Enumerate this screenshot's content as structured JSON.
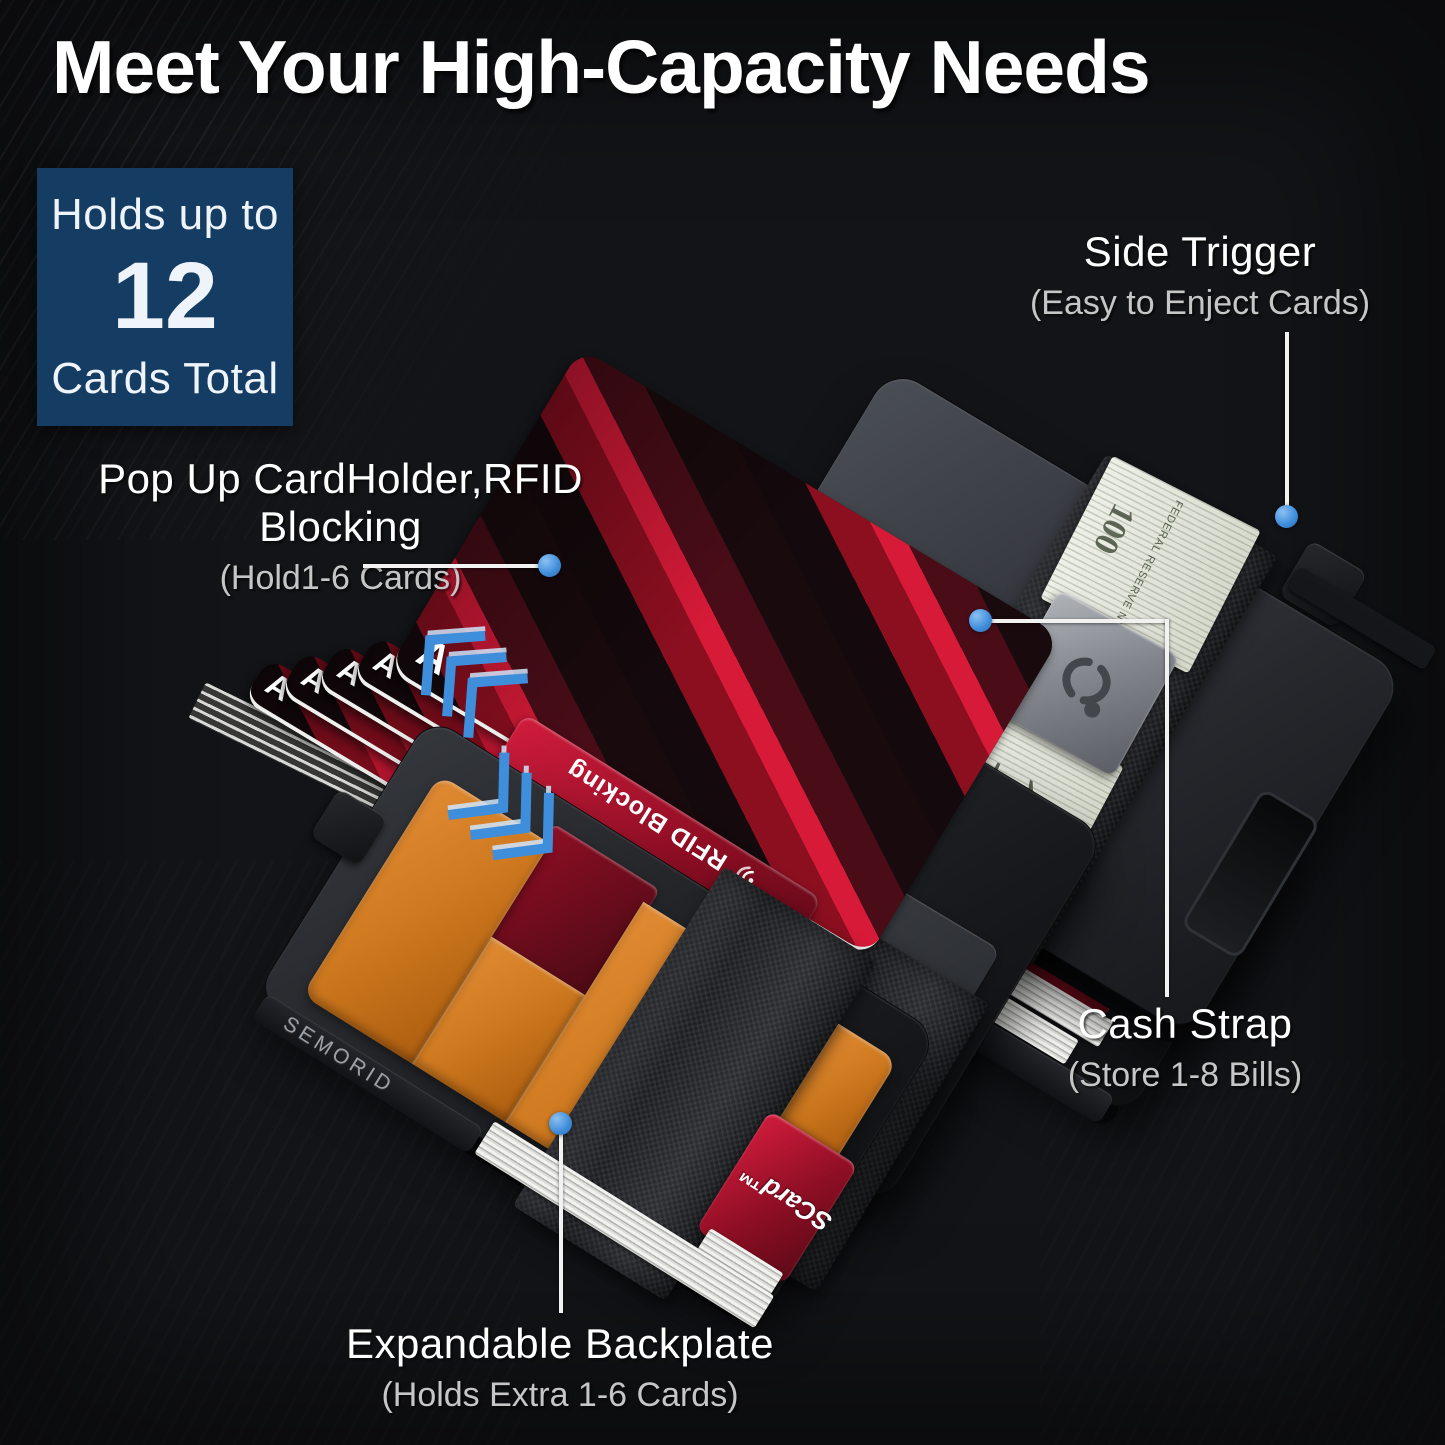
{
  "title": "Meet Your High-Capacity Needs",
  "badge": {
    "line1": "Holds up to",
    "number": "12",
    "line2": "Cards Total"
  },
  "callouts": {
    "side_trigger": {
      "label": "Side Trigger",
      "detail": "(Easy to Enject Cards)"
    },
    "popup": {
      "label": "Pop Up CardHolder,RFID Blocking",
      "detail": "(Hold1-6 Cards)"
    },
    "cash_strap": {
      "label": "Cash Strap",
      "detail": "(Store 1-8 Bills)"
    },
    "backplate": {
      "label": "Expandable Backplate",
      "detail": "(Holds Extra 1-6 Cards)"
    }
  },
  "product": {
    "brand": "SEMORID",
    "card_letter": "A",
    "rfid_card_text": "RFID Blocking",
    "red_card_brand": "SCard™",
    "bill_denomination": "100",
    "bill_micro_text": "FEDERAL RESERVE NOTE"
  },
  "colors": {
    "background": "#131417",
    "badge_navy": "#153c63",
    "accent_blue": "#3f8edb",
    "orange_leather": "#cf7a20",
    "red_card": "#a61228",
    "callout_line": "#f2f2f2",
    "case_gray": "#2b2d31"
  }
}
